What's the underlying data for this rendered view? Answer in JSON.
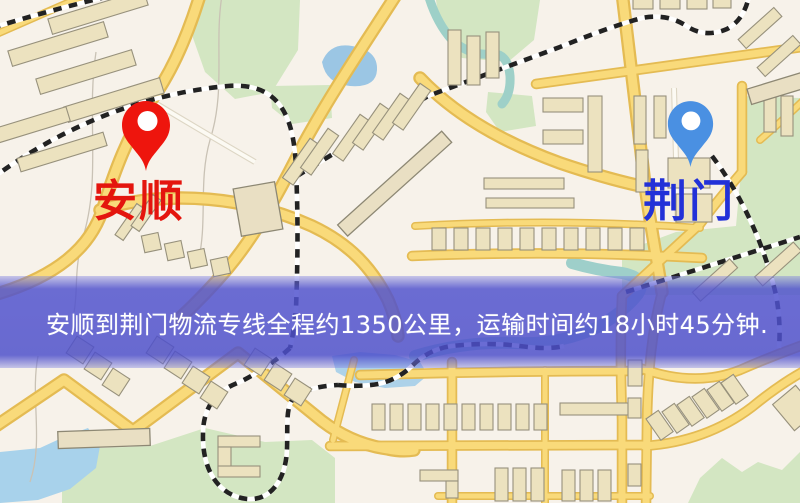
{
  "markers": {
    "origin": {
      "label": "安顺",
      "pin_color": "#ee150d",
      "label_color": "#e4150e"
    },
    "destination": {
      "label": "荆门",
      "pin_color": "#4a90e2",
      "label_color": "#2231d8"
    }
  },
  "banner": {
    "text": "安顺到荆门物流专线全程约1350公里，运输时间约18小时45分钟.",
    "background_color": "#4f51cb",
    "text_color": "#ffffff"
  },
  "map": {
    "palette": {
      "background": "#f7f2ea",
      "road_fill": "#f8da7d",
      "road_casing": "#e3bb56",
      "park": "#d3e6c3",
      "lake": "#9cc6e3",
      "river": "#9fcfca",
      "building": "#ece2c0",
      "railway": "#222222"
    }
  }
}
